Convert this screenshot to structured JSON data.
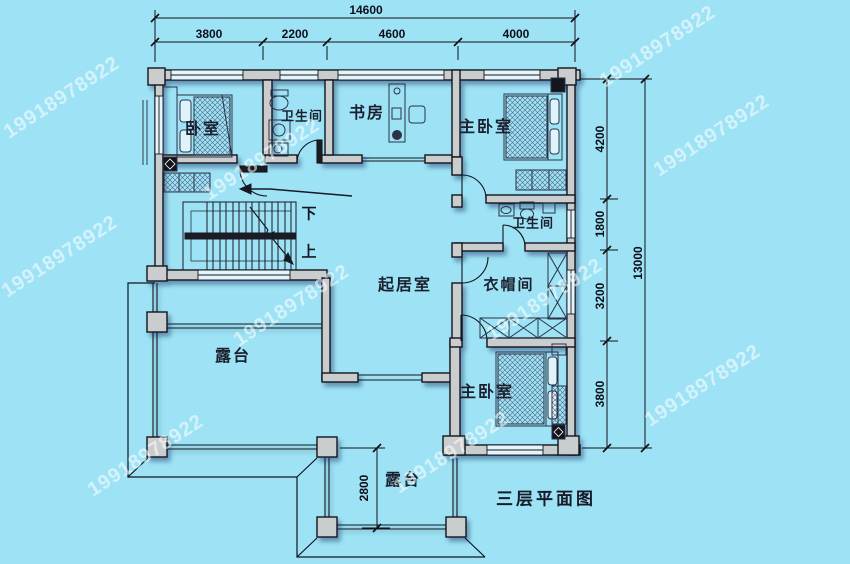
{
  "plan": {
    "title": "三层平面图",
    "watermark": "19918978922",
    "rooms": {
      "bedroom": "卧室",
      "bath_top": "卫生间",
      "study": "书房",
      "master_top": "主卧室",
      "living": "起居室",
      "bath_mid": "卫生间",
      "cloakroom": "衣帽间",
      "master_bottom": "主卧室",
      "terrace_big": "露台",
      "terrace_small": "露台"
    },
    "stairs": {
      "down": "下",
      "up": "上"
    },
    "dimensions": {
      "top_total": "14600",
      "top_segments": [
        "3800",
        "2200",
        "4600",
        "4000"
      ],
      "right_total": "13000",
      "right_segments": [
        "4200",
        "1800",
        "3200",
        "3800"
      ],
      "terrace_depth": "2800"
    },
    "colors": {
      "background": "#9EE3F5",
      "wall_fill": "#C9CDCD",
      "line": "#111111",
      "watermark": "rgba(255,255,255,0.55)"
    }
  }
}
